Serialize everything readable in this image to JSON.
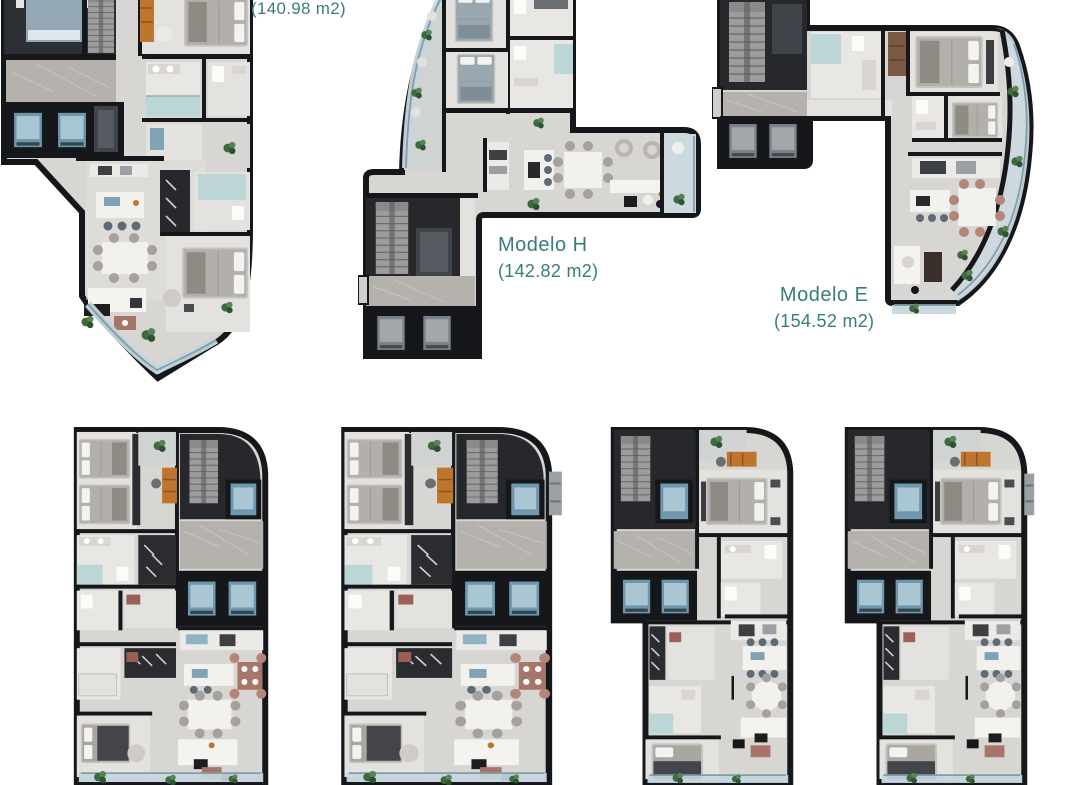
{
  "page": {
    "width": 1080,
    "height": 785,
    "background": "#ffffff",
    "description": "Sheet of seven apartment floor-plan renderings, three labeled"
  },
  "palette": {
    "accent_text": "#377e79",
    "wall": "#15171a",
    "floor": "#d8d6d2",
    "marble": "#b5b2ae",
    "dark_core": "#26282c",
    "elevator_blue": "#6e97ad",
    "glass": "#c6d6dc",
    "shower_glass": "#b7d4d6",
    "wood_orange": "#c0752f",
    "terracotta": "#a8756a",
    "plant_green": "#3c6b40"
  },
  "icons": [
    "plant-icon",
    "stairs-icon",
    "elevator-icon"
  ],
  "plans": {
    "top_left": {
      "area": "(140.98 m2)"
    },
    "modelo_h": {
      "name": "Modelo H",
      "area": "(142.82 m2)"
    },
    "modelo_e": {
      "name": "Modelo E",
      "area": "(154.52 m2)"
    }
  }
}
